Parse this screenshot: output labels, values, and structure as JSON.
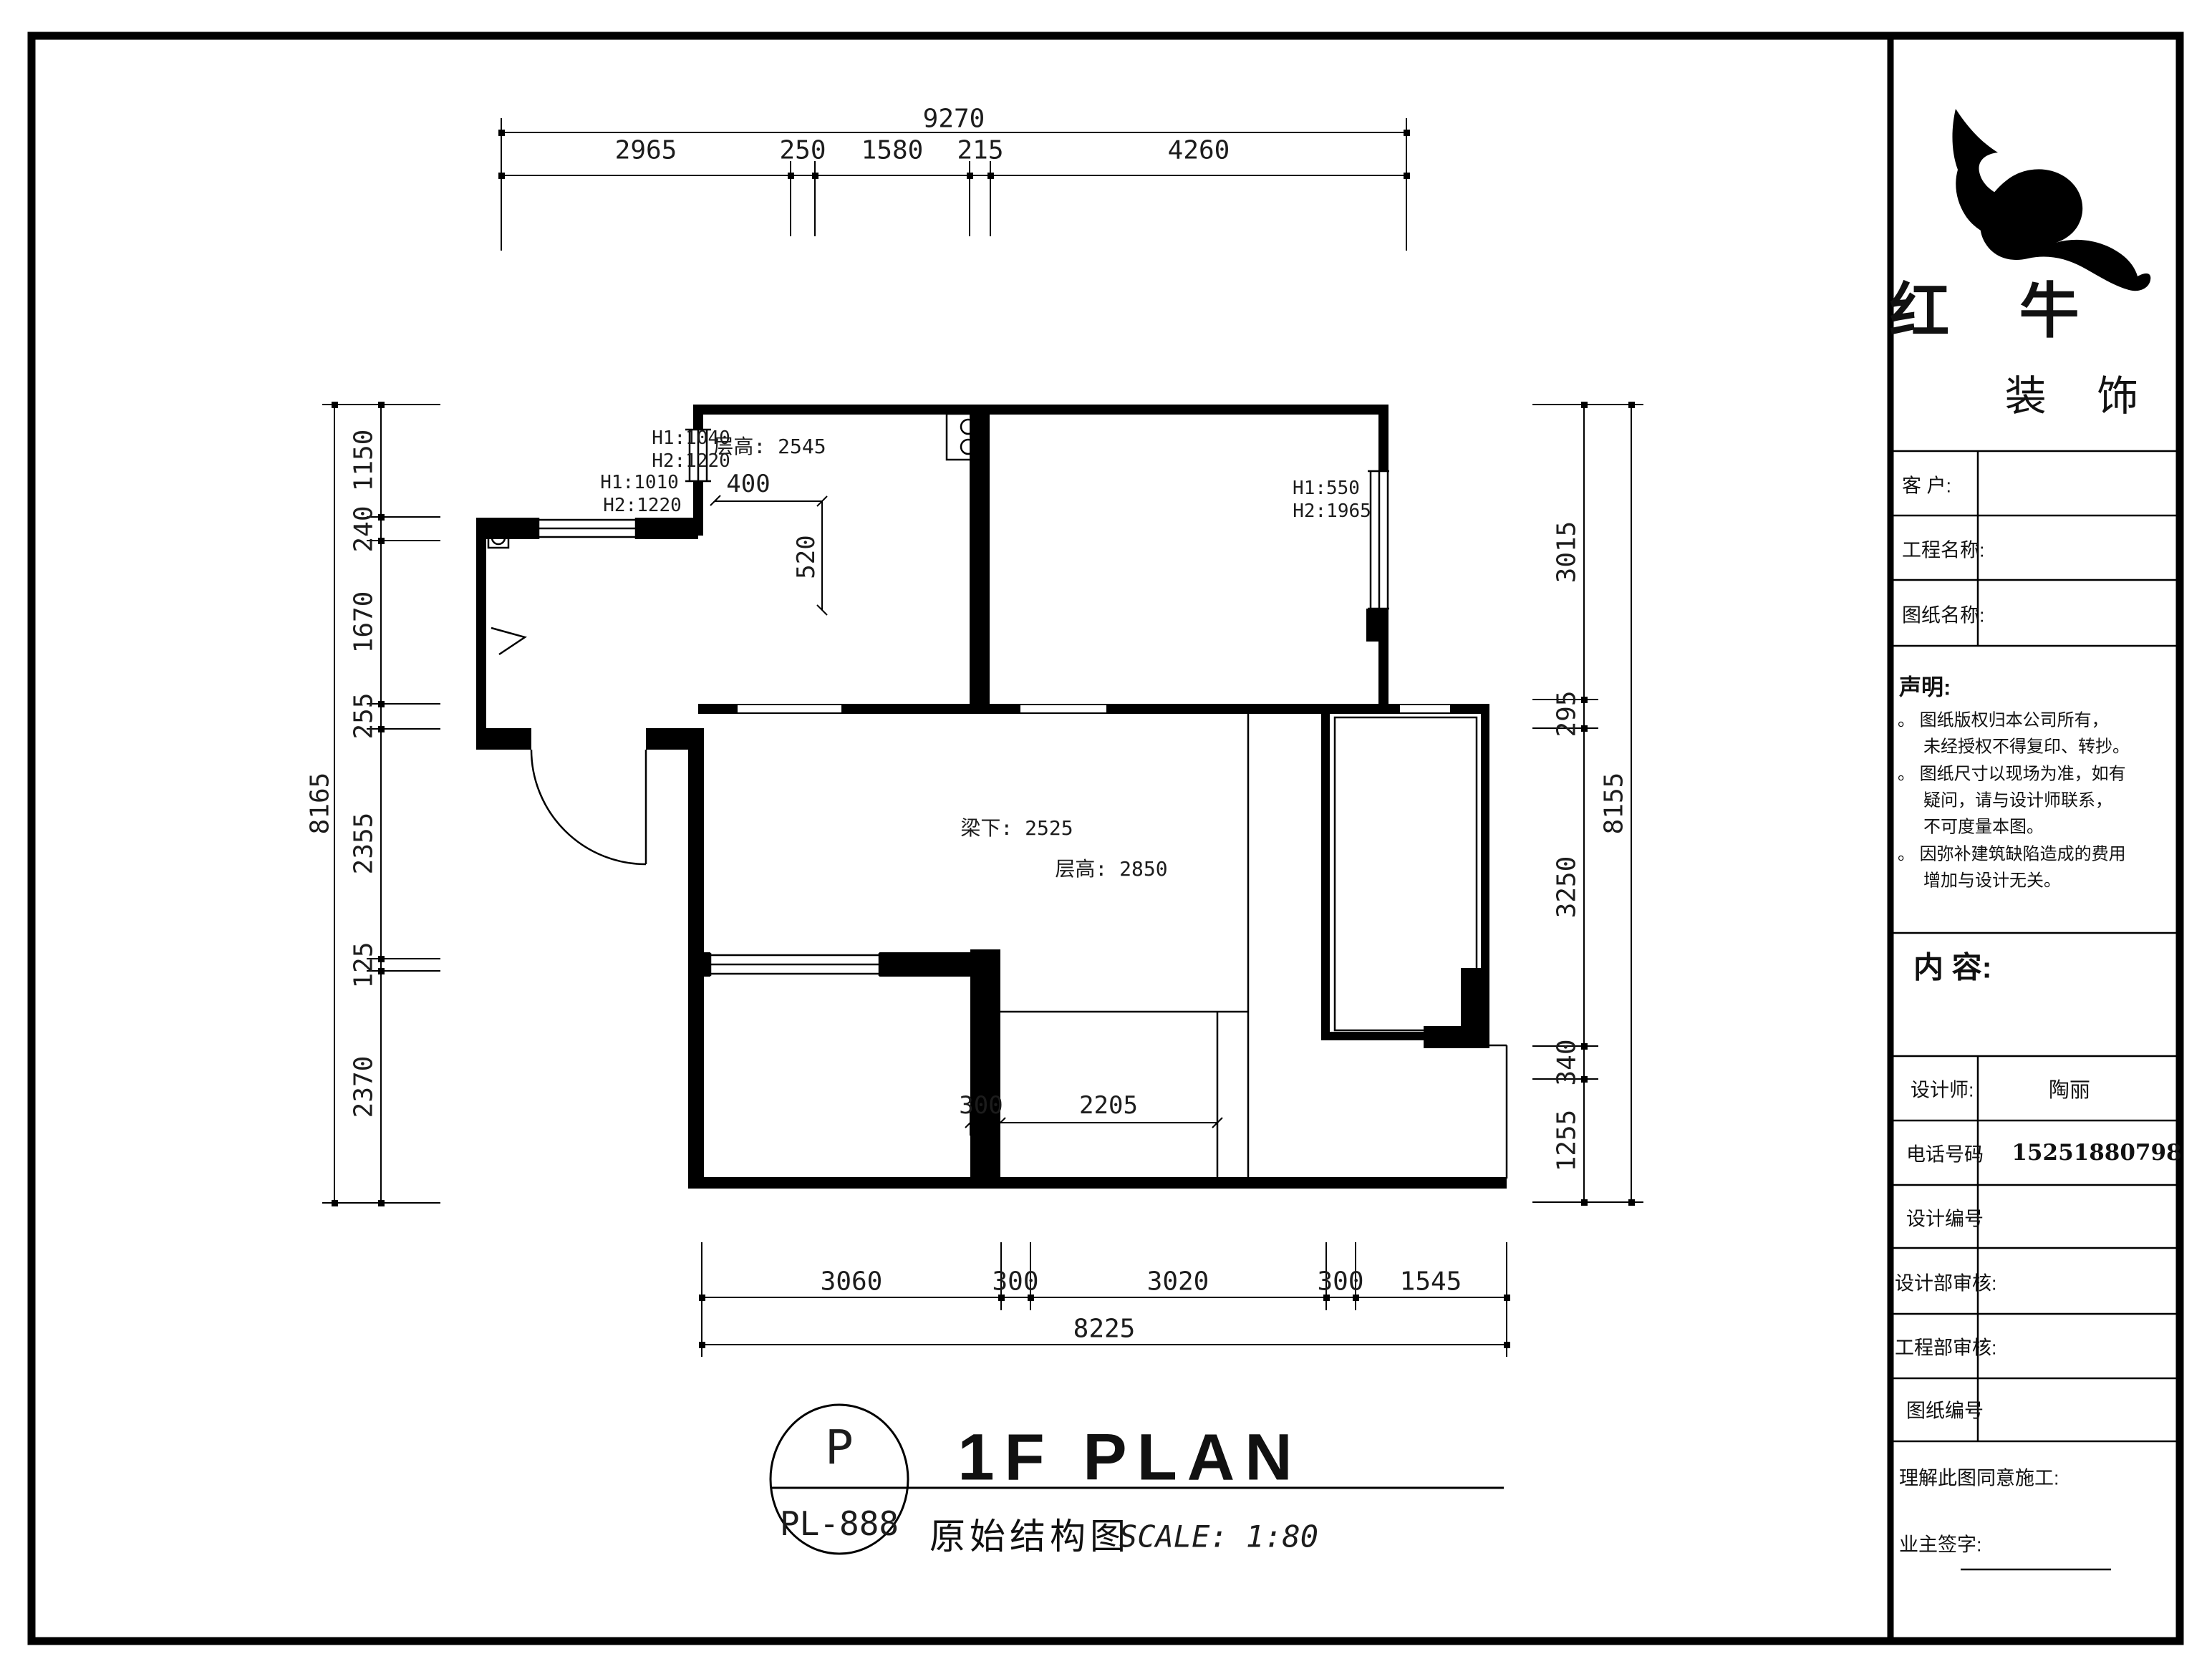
{
  "plan": {
    "title": {
      "bubble_letter": "P",
      "bubble_code": "PL-888",
      "name_en": "1F PLAN",
      "name_cn": "原始结构图",
      "scale": "SCALE: 1:80"
    },
    "dims": {
      "top": {
        "total": "9270",
        "segs": [
          "2965",
          "250",
          "1580",
          "215",
          "4260"
        ]
      },
      "left": {
        "total": "8165",
        "segs": [
          "1150",
          "240",
          "1670",
          "255",
          "2355",
          "125",
          "2370"
        ]
      },
      "right": {
        "total": "8155",
        "segs": [
          "3015",
          "295",
          "3250",
          "340",
          "1255"
        ]
      },
      "bottom": {
        "total": "8225",
        "segs": [
          "3060",
          "300",
          "3020",
          "300",
          "1545"
        ]
      }
    },
    "annotations": {
      "win_a1": "H1:1010",
      "win_a2": "H2:1220",
      "win_b1": "H1:1040",
      "win_b2": "H2:1220",
      "win_c1": "H1:550",
      "win_c2": "H2:1965",
      "kitchen_h": "层高: 2545",
      "beam": "梁下: 2525",
      "living_h": "层高: 2850",
      "d400": "400",
      "d520": "520",
      "d300": "300",
      "d2205": "2205"
    }
  },
  "titleblock": {
    "brand_main": "红 牛",
    "brand_sub": "装 饰",
    "fields_top": [
      {
        "label": "客 户:"
      },
      {
        "label": "工程名称:"
      },
      {
        "label": "图纸名称:"
      }
    ],
    "statement_title": "声明:",
    "statement": [
      "。 图纸版权归本公司所有，",
      "未经授权不得复印、转抄。",
      "。 图纸尺寸以现场为准，如有",
      "疑问，请与设计师联系，",
      "不可度量本图。",
      "。 因弥补建筑缺陷造成的费用",
      "增加与设计无关。"
    ],
    "content_label": "内 容:",
    "fields_bottom": [
      {
        "label": "设计师:",
        "value": "陶丽"
      },
      {
        "label": "电话号码",
        "value": "15251880798"
      },
      {
        "label": "设计编号",
        "value": ""
      },
      {
        "label": "设计部审核:",
        "value": ""
      },
      {
        "label": "工程部审核:",
        "value": ""
      },
      {
        "label": "图纸编号",
        "value": ""
      }
    ],
    "footer_line1": "理解此图同意施工:",
    "footer_line2": "业主签字:"
  }
}
